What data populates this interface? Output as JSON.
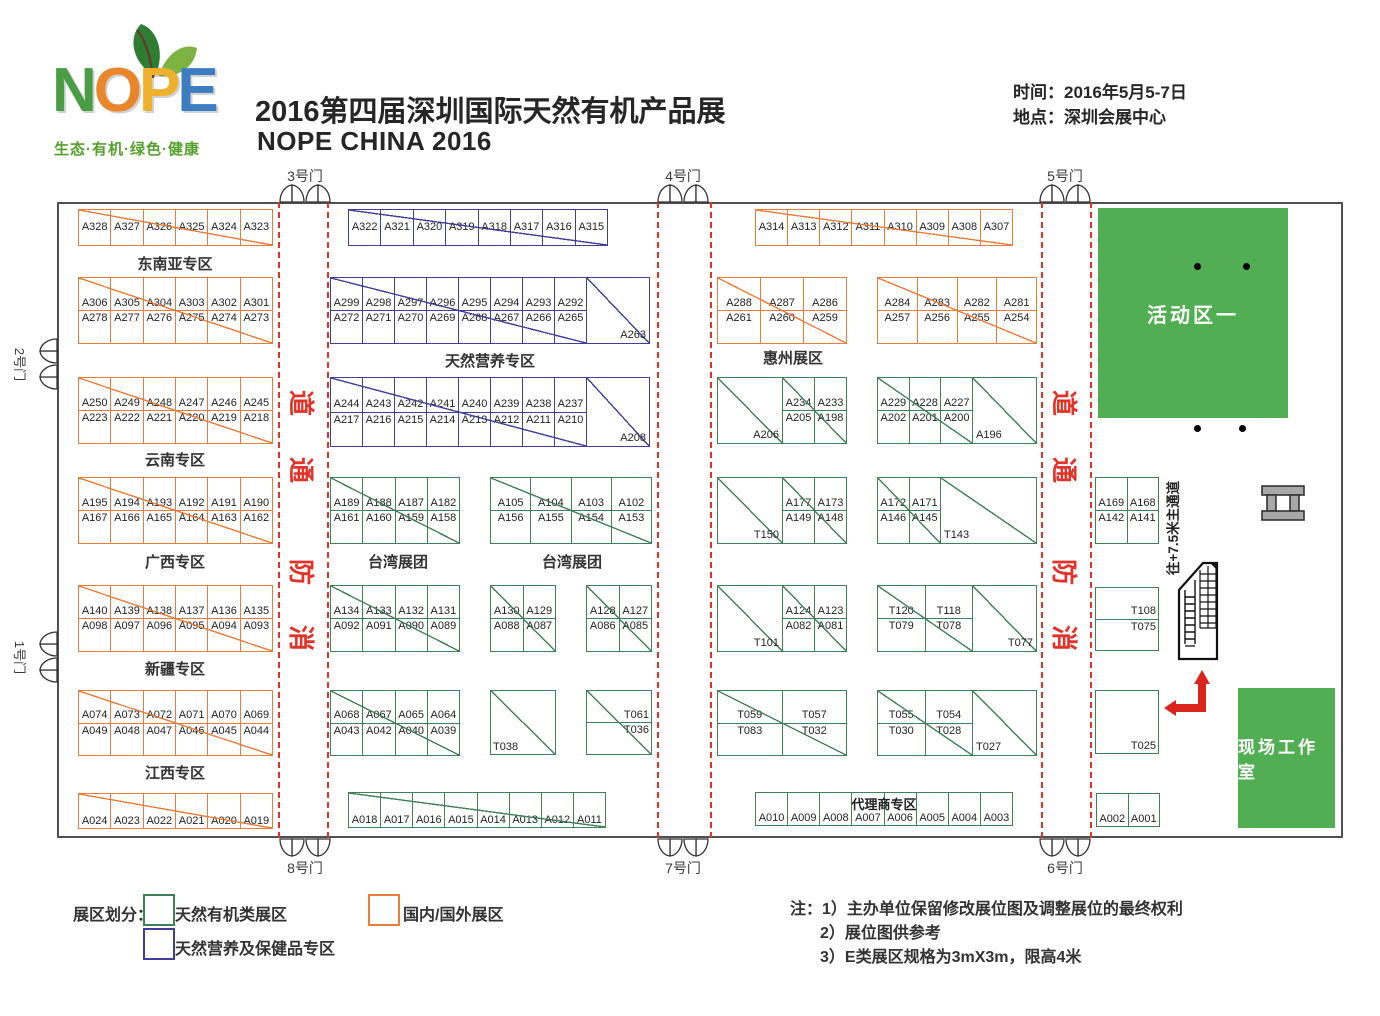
{
  "header": {
    "logo": {
      "letters": [
        {
          "ch": "N",
          "color": "#4a9d45"
        },
        {
          "ch": "O",
          "color": "#e9862c"
        },
        {
          "ch": "P",
          "color": "#eeb02f"
        },
        {
          "ch": "E",
          "color": "#3c7cc0"
        }
      ],
      "tagline": "生态·有机·绿色·健康"
    },
    "title_cn": "2016第四届深圳国际天然有机产品展",
    "title_en": "NOPE CHINA 2016",
    "info": [
      {
        "label": "时间：",
        "value": "2016年5月5-7日"
      },
      {
        "label": "地点：",
        "value": "深圳会展中心"
      }
    ]
  },
  "colors": {
    "orange": "#e87c3a",
    "blue": "#3f3f9a",
    "green": "#3f8058",
    "area_green": "#52ae52",
    "red": "#e23328",
    "arrow_red": "#d9251d",
    "wall": "#4f4f4f"
  },
  "floorplan": {
    "vertical_note": "往+7.5米主通道",
    "corridor_char_y": [
      403,
      470,
      572,
      638
    ],
    "corridors": [
      {
        "x1": 278,
        "x2": 327,
        "chars": [
          "道",
          "通",
          "防",
          "消"
        ]
      },
      {
        "x1": 657,
        "x2": 710,
        "chars": []
      },
      {
        "x1": 1041,
        "x2": 1090,
        "chars": [
          "道",
          "通",
          "防",
          "消"
        ]
      }
    ],
    "gates": [
      {
        "label": "3号门",
        "side": "top",
        "pos": 305
      },
      {
        "label": "4号门",
        "side": "top",
        "pos": 683
      },
      {
        "label": "5号门",
        "side": "top",
        "pos": 1065
      },
      {
        "label": "8号门",
        "side": "bottom",
        "pos": 305
      },
      {
        "label": "7号门",
        "side": "bottom",
        "pos": 683
      },
      {
        "label": "6号门",
        "side": "bottom",
        "pos": 1065
      },
      {
        "label": "2号门",
        "side": "left",
        "pos": 364
      },
      {
        "label": "1号门",
        "side": "left",
        "pos": 657
      }
    ],
    "section_labels": [
      {
        "text": "东南亚专区",
        "x": 175,
        "y": 253
      },
      {
        "text": "云南专区",
        "x": 175,
        "y": 449
      },
      {
        "text": "广西专区",
        "x": 175,
        "y": 551
      },
      {
        "text": "新疆专区",
        "x": 175,
        "y": 658
      },
      {
        "text": "江西专区",
        "x": 175,
        "y": 762
      },
      {
        "text": "天然营养专区",
        "x": 490,
        "y": 350
      },
      {
        "text": "台湾展团",
        "x": 398,
        "y": 551
      },
      {
        "text": "台湾展团",
        "x": 572,
        "y": 551
      },
      {
        "text": "惠州展区",
        "x": 793,
        "y": 347
      }
    ],
    "areas": [
      {
        "label": "活动区一",
        "x": 1098,
        "y": 208,
        "w": 190,
        "h": 210,
        "font": 20
      },
      {
        "label": "现场工作室",
        "x": 1238,
        "y": 688,
        "w": 97,
        "h": 140,
        "font": 17
      }
    ],
    "dots": [
      [
        1197,
        266
      ],
      [
        1246,
        266
      ],
      [
        1197,
        428
      ],
      [
        1242,
        428
      ]
    ],
    "blocks": [
      {
        "x": 78,
        "y": 209,
        "w": 195,
        "h": 37,
        "color": "orange",
        "rows": [
          [
            "A328",
            "A327",
            "A326",
            "A325",
            "A324",
            "A323"
          ]
        ]
      },
      {
        "x": 78,
        "y": 277,
        "w": 195,
        "h": 67,
        "color": "orange",
        "rows": [
          [
            "A306",
            "A305",
            "A304",
            "A303",
            "A302",
            "A301"
          ],
          [
            "A278",
            "A277",
            "A276",
            "A275",
            "A274",
            "A273"
          ]
        ]
      },
      {
        "x": 78,
        "y": 377,
        "w": 195,
        "h": 67,
        "color": "orange",
        "rows": [
          [
            "A250",
            "A249",
            "A248",
            "A247",
            "A246",
            "A245"
          ],
          [
            "A223",
            "A222",
            "A221",
            "A220",
            "A219",
            "A218"
          ]
        ]
      },
      {
        "x": 78,
        "y": 477,
        "w": 195,
        "h": 67,
        "color": "orange",
        "rows": [
          [
            "A195",
            "A194",
            "A193",
            "A192",
            "A191",
            "A190"
          ],
          [
            "A167",
            "A166",
            "A165",
            "A164",
            "A163",
            "A162"
          ]
        ]
      },
      {
        "x": 78,
        "y": 585,
        "w": 195,
        "h": 67,
        "color": "orange",
        "rows": [
          [
            "A140",
            "A139",
            "A138",
            "A137",
            "A136",
            "A135"
          ],
          [
            "A098",
            "A097",
            "A096",
            "A095",
            "A094",
            "A093"
          ]
        ]
      },
      {
        "x": 78,
        "y": 690,
        "w": 195,
        "h": 66,
        "color": "orange",
        "rows": [
          [
            "A074",
            "A073",
            "A072",
            "A071",
            "A070",
            "A069"
          ],
          [
            "A049",
            "A048",
            "A047",
            "A046",
            "A045",
            "A044"
          ]
        ]
      },
      {
        "x": 78,
        "y": 793,
        "w": 195,
        "h": 36,
        "color": "orange",
        "lpos": "bottom",
        "rows": [
          [
            "A024",
            "A023",
            "A022",
            "A021",
            "A020",
            "A019"
          ]
        ]
      },
      {
        "x": 348,
        "y": 209,
        "w": 260,
        "h": 37,
        "color": "blue",
        "rows": [
          [
            "A322",
            "A321",
            "A320",
            "A319",
            "A318",
            "A317",
            "A316",
            "A315"
          ]
        ]
      },
      {
        "x": 330,
        "y": 277,
        "w": 320,
        "h": 67,
        "color": "blue",
        "big_right": {
          "label": "A263",
          "w": 63,
          "align": "br"
        },
        "rows": [
          [
            "A299",
            "A298",
            "A297",
            "A296",
            "A295",
            "A294",
            "A293",
            "A292"
          ],
          [
            "A272",
            "A271",
            "A270",
            "A269",
            "A268",
            "A267",
            "A266",
            "A265"
          ]
        ]
      },
      {
        "x": 330,
        "y": 377,
        "w": 320,
        "h": 70,
        "color": "blue",
        "big_right": {
          "label": "A208",
          "w": 63,
          "align": "br"
        },
        "rows": [
          [
            "A244",
            "A243",
            "A242",
            "A241",
            "A240",
            "A239",
            "A238",
            "A237"
          ],
          [
            "A217",
            "A216",
            "A215",
            "A214",
            "A213",
            "A212",
            "A211",
            "A210"
          ]
        ]
      },
      {
        "x": 330,
        "y": 477,
        "w": 130,
        "h": 67,
        "color": "green",
        "rows": [
          [
            "A189",
            "A188",
            "A187",
            "A182"
          ],
          [
            "A161",
            "A160",
            "A159",
            "A158"
          ]
        ]
      },
      {
        "x": 490,
        "y": 477,
        "w": 162,
        "h": 67,
        "color": "green",
        "rows": [
          [
            "A105",
            "A104",
            "A103",
            "A102"
          ],
          [
            "A156",
            "A155",
            "A154",
            "A153"
          ]
        ]
      },
      {
        "x": 330,
        "y": 585,
        "w": 130,
        "h": 67,
        "color": "green",
        "rows": [
          [
            "A134",
            "A133",
            "A132",
            "A131"
          ],
          [
            "A092",
            "A091",
            "A090",
            "A089"
          ]
        ]
      },
      {
        "x": 490,
        "y": 585,
        "w": 66,
        "h": 67,
        "color": "green",
        "rows": [
          [
            "A130",
            "A129"
          ],
          [
            "A088",
            "A087"
          ]
        ]
      },
      {
        "x": 586,
        "y": 585,
        "w": 66,
        "h": 67,
        "color": "green",
        "rows": [
          [
            "A128",
            "A127"
          ],
          [
            "A086",
            "A085"
          ]
        ]
      },
      {
        "x": 330,
        "y": 690,
        "w": 130,
        "h": 66,
        "color": "green",
        "rows": [
          [
            "A068",
            "A067",
            "A065",
            "A064"
          ],
          [
            "A043",
            "A042",
            "A040",
            "A039"
          ]
        ]
      },
      {
        "x": 490,
        "y": 690,
        "w": 66,
        "h": 65,
        "color": "green",
        "lpos": "bl",
        "rows": [
          [
            "T038"
          ]
        ]
      },
      {
        "x": 586,
        "y": 690,
        "w": 66,
        "h": 65,
        "color": "green",
        "lpos": "right",
        "rows": [
          [
            "T061"
          ],
          [
            "T036"
          ]
        ]
      },
      {
        "x": 348,
        "y": 792,
        "w": 258,
        "h": 36,
        "color": "green",
        "lpos": "bottom",
        "rows": [
          [
            "A018",
            "A017",
            "A016",
            "A015",
            "A014",
            "A013",
            "A012",
            "A011"
          ]
        ]
      },
      {
        "x": 755,
        "y": 209,
        "w": 258,
        "h": 37,
        "color": "orange",
        "rows": [
          [
            "A314",
            "A313",
            "A312",
            "A311",
            "A310",
            "A309",
            "A308",
            "A307"
          ]
        ]
      },
      {
        "x": 717,
        "y": 277,
        "w": 130,
        "h": 67,
        "color": "orange",
        "rows": [
          [
            "A288",
            "A287",
            "A286"
          ],
          [
            "A261",
            "A260",
            "A259"
          ]
        ]
      },
      {
        "x": 877,
        "y": 277,
        "w": 160,
        "h": 67,
        "color": "orange",
        "rows": [
          [
            "A284",
            "A283",
            "A282",
            "A281"
          ],
          [
            "A257",
            "A256",
            "A255",
            "A254"
          ]
        ]
      },
      {
        "x": 717,
        "y": 377,
        "w": 130,
        "h": 67,
        "color": "green",
        "big_left": {
          "label": "A206",
          "w": 65,
          "align": "br"
        },
        "rows": [
          [
            "A234",
            "A233"
          ],
          [
            "A205",
            "A198"
          ]
        ]
      },
      {
        "x": 877,
        "y": 377,
        "w": 160,
        "h": 67,
        "color": "green",
        "big_right": {
          "label": "A196",
          "w": 64,
          "align": "bl"
        },
        "rows": [
          [
            "A229",
            "A228",
            "A227"
          ],
          [
            "A202",
            "A201",
            "A200"
          ]
        ]
      },
      {
        "x": 717,
        "y": 477,
        "w": 130,
        "h": 67,
        "color": "green",
        "big_left": {
          "label": "T150",
          "w": 65,
          "align": "br"
        },
        "rows": [
          [
            "A177",
            "A173"
          ],
          [
            "A149",
            "A148"
          ]
        ]
      },
      {
        "x": 877,
        "y": 477,
        "w": 160,
        "h": 67,
        "color": "green",
        "big_right": {
          "label": "T143",
          "w": 96,
          "align": "bl"
        },
        "rows": [
          [
            "A172",
            "A171"
          ],
          [
            "A146",
            "A145"
          ]
        ]
      },
      {
        "x": 717,
        "y": 585,
        "w": 130,
        "h": 67,
        "color": "green",
        "big_left": {
          "label": "T101",
          "w": 65,
          "align": "br"
        },
        "rows": [
          [
            "A124",
            "A123"
          ],
          [
            "A082",
            "A081"
          ]
        ]
      },
      {
        "x": 877,
        "y": 585,
        "w": 160,
        "h": 67,
        "color": "green",
        "big_right": {
          "label": "T077",
          "w": 64,
          "align": "br"
        },
        "rows": [
          [
            "T120",
            "T118"
          ],
          [
            "T079",
            "T078"
          ]
        ]
      },
      {
        "x": 717,
        "y": 690,
        "w": 130,
        "h": 66,
        "color": "green",
        "rows": [
          [
            "T059",
            "T057"
          ],
          [
            "T083",
            "T032"
          ]
        ]
      },
      {
        "x": 877,
        "y": 690,
        "w": 160,
        "h": 66,
        "color": "green",
        "big_right": {
          "label": "T027",
          "w": 64,
          "align": "bl"
        },
        "rows": [
          [
            "T055",
            "T054"
          ],
          [
            "T030",
            "T028"
          ]
        ]
      },
      {
        "x": 755,
        "y": 792,
        "w": 258,
        "h": 34,
        "color": "green",
        "lpos": "bottom",
        "diag": false,
        "overlay_label": "代理商专区",
        "rows": [
          [
            "A010",
            "A009",
            "A008",
            "A007",
            "A006",
            "A005",
            "A004",
            "A003"
          ]
        ]
      },
      {
        "x": 1095,
        "y": 477,
        "w": 64,
        "h": 67,
        "color": "green",
        "diag": false,
        "rows": [
          [
            "A169",
            "A168"
          ],
          [
            "A142",
            "A141"
          ]
        ]
      },
      {
        "x": 1095,
        "y": 587,
        "w": 64,
        "h": 64,
        "color": "green",
        "diag": false,
        "lpos": "right",
        "rows": [
          [
            "T108"
          ],
          [
            "T075"
          ]
        ]
      },
      {
        "x": 1095,
        "y": 690,
        "w": 64,
        "h": 64,
        "color": "green",
        "diag": false,
        "lpos": "br",
        "rows": [
          [
            "T025"
          ]
        ]
      },
      {
        "x": 1096,
        "y": 793,
        "w": 64,
        "h": 34,
        "color": "green",
        "diag": false,
        "lpos": "bottom",
        "rows": [
          [
            "A002",
            "A001"
          ]
        ]
      }
    ]
  },
  "legend": {
    "title": "展区划分：",
    "items": [
      {
        "color": "green",
        "label": "天然有机类展区"
      },
      {
        "color": "blue",
        "label": "天然营养及保健品专区"
      },
      {
        "color": "orange",
        "label": "国内/国外展区"
      }
    ]
  },
  "notes": {
    "prefix": "注：",
    "lines": [
      "1）主办单位保留修改展位图及调整展位的最终权利",
      "2）展位图供参考",
      "3）E类展区规格为3mX3m，限高4米"
    ]
  }
}
